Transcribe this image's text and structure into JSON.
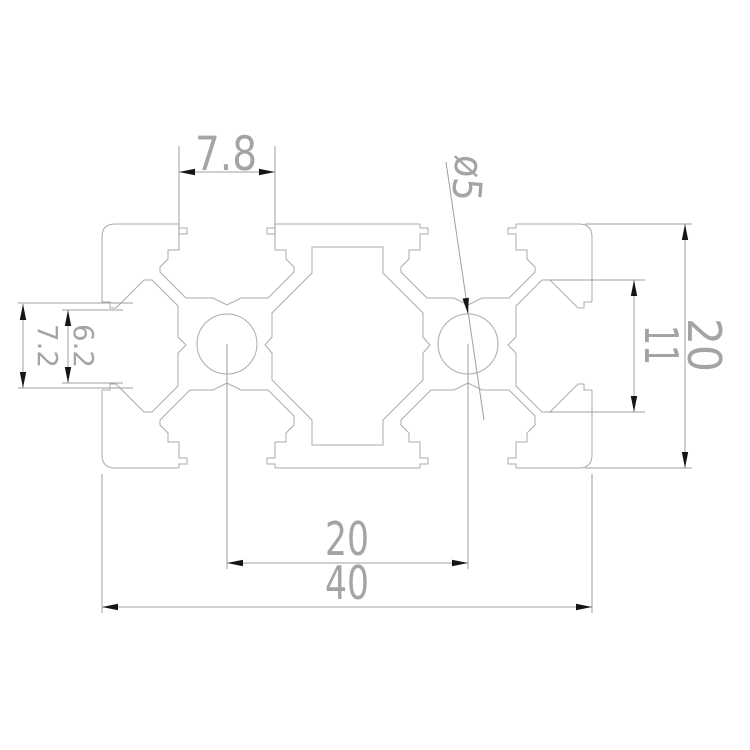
{
  "drawing": {
    "title": "2040 aluminium extrusion profile cross-section",
    "colors": {
      "background": "#ffffff",
      "geometry_line": "#a9abaa",
      "dimension_line": "#9f9f9f",
      "arrow": "#161616",
      "text": "#a3a5a4"
    },
    "dimensions": {
      "top_slot_width": "7.8",
      "hole_diameter": "ø5",
      "left_slot_inner_height": "6.2",
      "left_slot_outer_height": "7.2",
      "profile_height": "20",
      "end_slot_cavity_width": "11",
      "hole_center_spacing": "20",
      "profile_width": "40"
    }
  }
}
